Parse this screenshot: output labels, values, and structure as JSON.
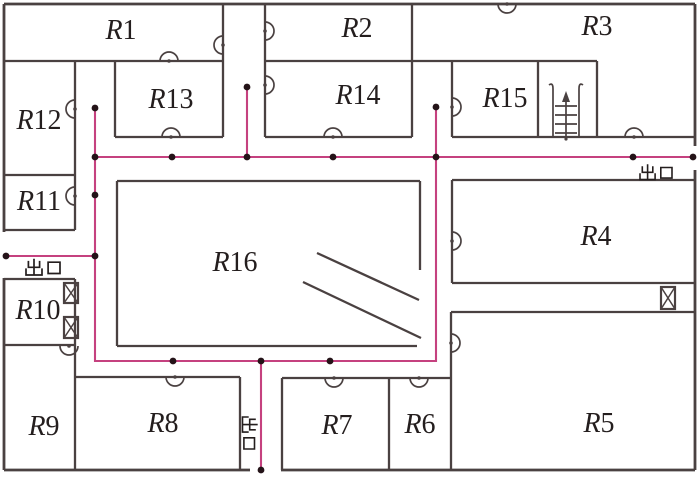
{
  "figure": {
    "type": "floor-plan-evacuation-diagram"
  },
  "colors": {
    "wall": "#4a4141",
    "door": "#4a4141",
    "path": "#c5417f",
    "node": "#241318",
    "text": "#241e1e",
    "bg": "#ffffff"
  },
  "rooms": [
    {
      "prefix": "R",
      "num": "1",
      "x": 121,
      "y": 30
    },
    {
      "prefix": "R",
      "num": "2",
      "x": 357,
      "y": 28
    },
    {
      "prefix": "R",
      "num": "3",
      "x": 597,
      "y": 26
    },
    {
      "prefix": "R",
      "num": "4",
      "x": 596,
      "y": 236
    },
    {
      "prefix": "R",
      "num": "5",
      "x": 599,
      "y": 423
    },
    {
      "prefix": "R",
      "num": "6",
      "x": 420,
      "y": 424
    },
    {
      "prefix": "R",
      "num": "7",
      "x": 337,
      "y": 425
    },
    {
      "prefix": "R",
      "num": "8",
      "x": 163,
      "y": 423
    },
    {
      "prefix": "R",
      "num": "9",
      "x": 44,
      "y": 426
    },
    {
      "prefix": "R",
      "num": "10",
      "x": 38,
      "y": 310
    },
    {
      "prefix": "R",
      "num": "11",
      "x": 39,
      "y": 201
    },
    {
      "prefix": "R",
      "num": "12",
      "x": 39,
      "y": 120
    },
    {
      "prefix": "R",
      "num": "13",
      "x": 171,
      "y": 99
    },
    {
      "prefix": "R",
      "num": "14",
      "x": 358,
      "y": 95
    },
    {
      "prefix": "R",
      "num": "15",
      "x": 505,
      "y": 98
    },
    {
      "prefix": "R",
      "num": "16",
      "x": 235,
      "y": 262
    }
  ],
  "room_label_size": 28,
  "exits": [
    {
      "label": "出口",
      "x": 44,
      "y": 267,
      "size": 17,
      "rotate": 0
    },
    {
      "label": "出口",
      "x": 657,
      "y": 172,
      "size": 16,
      "rotate": 0
    },
    {
      "label": "出口",
      "x": 250,
      "y": 434,
      "size": 16,
      "rotate": 90
    }
  ],
  "plan": {
    "width": 700,
    "height": 479,
    "outer": [
      [
        4,
        4,
        695,
        4
      ],
      [
        695,
        4,
        695,
        146
      ],
      [
        695,
        170,
        695,
        470
      ],
      [
        695,
        470,
        281,
        470
      ],
      [
        250,
        470,
        4,
        470
      ],
      [
        4,
        470,
        4,
        278
      ],
      [
        4,
        232,
        4,
        4
      ]
    ],
    "walls": [
      [
        4,
        61,
        223,
        61
      ],
      [
        223,
        4,
        223,
        137
      ],
      [
        265,
        4,
        265,
        137
      ],
      [
        265,
        61,
        452,
        61
      ],
      [
        412,
        4,
        412,
        137
      ],
      [
        452,
        61,
        597,
        61
      ],
      [
        452,
        61,
        452,
        137
      ],
      [
        538,
        61,
        538,
        137
      ],
      [
        597,
        61,
        597,
        137
      ],
      [
        115,
        61,
        115,
        137
      ],
      [
        115,
        137,
        223,
        137
      ],
      [
        265,
        137,
        412,
        137
      ],
      [
        452,
        137,
        695,
        137
      ],
      [
        75,
        61,
        75,
        230
      ],
      [
        4,
        175,
        75,
        175
      ],
      [
        4,
        230,
        75,
        230
      ],
      [
        117,
        181,
        420,
        181
      ],
      [
        117,
        181,
        117,
        346
      ],
      [
        117,
        346,
        417,
        346
      ],
      [
        420,
        181,
        420,
        270
      ],
      [
        317,
        253,
        419,
        300
      ],
      [
        303,
        282,
        421,
        338
      ],
      [
        452,
        180,
        695,
        180
      ],
      [
        452,
        180,
        452,
        283
      ],
      [
        452,
        283,
        695,
        283
      ],
      [
        451,
        312,
        695,
        312
      ],
      [
        451,
        312,
        451,
        470
      ],
      [
        4,
        279,
        75,
        279
      ],
      [
        75,
        279,
        75,
        470
      ],
      [
        4,
        345,
        75,
        345
      ],
      [
        75,
        377,
        240,
        377
      ],
      [
        240,
        377,
        240,
        470
      ],
      [
        282,
        378,
        282,
        470
      ],
      [
        282,
        378,
        451,
        378
      ],
      [
        389,
        378,
        389,
        470
      ]
    ],
    "door_radius": 9,
    "doors": [
      {
        "x": 169,
        "y": 61,
        "dir": "up"
      },
      {
        "x": 223,
        "y": 45,
        "dir": "left"
      },
      {
        "x": 265,
        "y": 31,
        "dir": "right"
      },
      {
        "x": 265,
        "y": 85,
        "dir": "right"
      },
      {
        "x": 333,
        "y": 137,
        "dir": "up"
      },
      {
        "x": 171,
        "y": 137,
        "dir": "up"
      },
      {
        "x": 75,
        "y": 109,
        "dir": "left"
      },
      {
        "x": 75,
        "y": 196,
        "dir": "left"
      },
      {
        "x": 452,
        "y": 107,
        "dir": "right"
      },
      {
        "x": 634,
        "y": 137,
        "dir": "up"
      },
      {
        "x": 507,
        "y": 4,
        "dir": "down"
      },
      {
        "x": 452,
        "y": 241,
        "dir": "right"
      },
      {
        "x": 451,
        "y": 343,
        "dir": "right"
      },
      {
        "x": 69,
        "y": 346,
        "dir": "down"
      },
      {
        "x": 175,
        "y": 377,
        "dir": "down"
      },
      {
        "x": 334,
        "y": 378,
        "dir": "down"
      },
      {
        "x": 419,
        "y": 378,
        "dir": "down"
      }
    ],
    "elevators": [
      {
        "x": 64,
        "y": 283,
        "w": 14,
        "h": 20
      },
      {
        "x": 64,
        "y": 317,
        "w": 14,
        "h": 21
      },
      {
        "x": 661,
        "y": 287,
        "w": 14,
        "h": 22
      }
    ],
    "stairs": {
      "x": 553,
      "y": 82,
      "w": 26,
      "h": 55
    },
    "path_polylines": [
      [
        [
          6,
          256
        ],
        [
          95,
          256
        ]
      ],
      [
        [
          95,
          108
        ],
        [
          95,
          361
        ],
        [
          436,
          361
        ],
        [
          436,
          107
        ]
      ],
      [
        [
          95,
          157
        ],
        [
          693,
          157
        ]
      ],
      [
        [
          247,
          87
        ],
        [
          247,
          157
        ]
      ],
      [
        [
          261,
          361
        ],
        [
          261,
          470
        ]
      ]
    ],
    "nodes": [
      [
        6,
        256
      ],
      [
        95,
        256
      ],
      [
        95,
        108
      ],
      [
        95,
        157
      ],
      [
        95,
        195
      ],
      [
        247,
        87
      ],
      [
        247,
        157
      ],
      [
        172,
        157
      ],
      [
        333,
        157
      ],
      [
        436,
        107
      ],
      [
        436,
        157
      ],
      [
        633,
        157
      ],
      [
        693,
        157
      ],
      [
        173,
        361
      ],
      [
        261,
        361
      ],
      [
        330,
        361
      ],
      [
        261,
        470
      ]
    ]
  }
}
